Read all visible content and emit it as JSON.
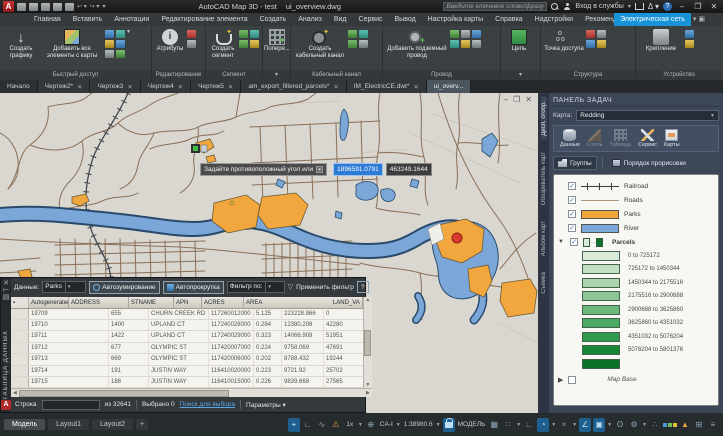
{
  "titlebar": {
    "app_title": "AutoCAD Map 3D - test",
    "doc_name": "ui_overview.dwg",
    "search_placeholder": "Введите ключевое слово/фразу",
    "signin_label": "Вход в службы"
  },
  "ribbon_tabs": [
    "Главная",
    "Вставить",
    "Аннотации",
    "Редактирование элемента",
    "Создать",
    "Анализ",
    "Вид",
    "Сервис",
    "Вывод",
    "Настройка карты",
    "Справка",
    "Надстройки",
    "Рекомендованные приложения"
  ],
  "active_ribbon_tab": "Электрическая сеть",
  "ribbon": {
    "g0": {
      "label": "Быстрый доступ",
      "b0": "Создать графику",
      "b1": "Добавить все элементы с карты"
    },
    "g1": {
      "label": "Редактирование",
      "b0": "Атрибуты"
    },
    "g2": {
      "label": "Сегмент",
      "b0": "Создать сегмент"
    },
    "g3": {
      "label": "",
      "b0": "Попере..."
    },
    "g4": {
      "label": "Кабельный канал",
      "b0": "Создать кабельный канал"
    },
    "g5": {
      "label": "Провод",
      "b0": "Добавить подземный провод"
    },
    "g6": {
      "label": "",
      "b0": "Цепь"
    },
    "g7": {
      "label": "Структура",
      "b0": "Точка доступа"
    },
    "g8": {
      "label": "Устройство",
      "b0": "Крепление"
    }
  },
  "doc_tabs": {
    "start": "Начало",
    "closable": [
      {
        "label": "Чертеж2*"
      },
      {
        "label": "Чертеж3"
      },
      {
        "label": "Чертеж4"
      },
      {
        "label": "Чертеж5"
      },
      {
        "label": "am_export_filtered_parcels*"
      },
      {
        "label": "IM_ElectricCE.dwt*"
      }
    ],
    "active": "ui_overv..."
  },
  "tooltip": {
    "prompt": "Задайте противоположный угол или",
    "x_value": "1896591.0791",
    "y_value": "463249.1644"
  },
  "datatable": {
    "strip_title": "ТАБЛИЦА ДАННЫХ",
    "toolbar": {
      "data_label": "Данные:",
      "layer_value": "Parks",
      "autozoom": "Автозумирование",
      "autoscroll": "Автопрокрутка",
      "filter_label": "Фильтр по:",
      "apply_filter": "Применить фильтр",
      "help": "?"
    },
    "columns": [
      "Autogenerated_SDF_ID",
      "ADDRESS",
      "STNAME",
      "APN",
      "ACRES",
      "AREA",
      "LAND_VA"
    ],
    "rows": [
      [
        "19709",
        "655",
        "CHURN CREEK RD",
        "117260012000",
        "5.125",
        "223228.866",
        "0"
      ],
      [
        "19710",
        "1400",
        "UPLAND CT",
        "117240028000",
        "0.284",
        "12380.208",
        "42280"
      ],
      [
        "19711",
        "1422",
        "UPLAND CT",
        "117240029000",
        "0.323",
        "14066.909",
        "51951"
      ],
      [
        "19712",
        "677",
        "OLYMPIC ST",
        "117420007000",
        "0.224",
        "9758.069",
        "47691"
      ],
      [
        "19713",
        "669",
        "OLYMPIC ST",
        "117420006000",
        "0.202",
        "8788.432",
        "19244"
      ],
      [
        "19714",
        "191",
        "JUSTIN WAY",
        "116410020000",
        "0.223",
        "9721.92",
        "25702"
      ],
      [
        "19715",
        "188",
        "JUSTIN WAY",
        "116410015000",
        "0.226",
        "9839.668",
        "27565"
      ]
    ],
    "footer": {
      "row_label": "Строка",
      "of_total": "из 32641",
      "selected": "Выбрано 0",
      "search_link": "Поиск для выбора",
      "params": "Параметры"
    }
  },
  "side_tabs": [
    "Дисп. отобр.",
    "Обозреватель карт",
    "Альбом карт",
    "Съемка"
  ],
  "taskpane": {
    "title": "ПАНЕЛЬ ЗАДАЧ",
    "map_label": "Карта:",
    "map_value": "Redding",
    "tools": [
      "Данные",
      "Стиль",
      "Таблица",
      "Сервис",
      "Карты"
    ],
    "groups_btn": "Группы",
    "draworder_btn": "Порядок прорисовки",
    "legend_items": [
      {
        "label": "Railroad"
      },
      {
        "label": "Roads",
        "color": "#b1957a"
      },
      {
        "label": "Parks",
        "color": "#f0a63c"
      },
      {
        "label": "River",
        "color": "#7ba7d9"
      },
      {
        "label": "Parcels"
      }
    ],
    "parcels_ramp": [
      {
        "label": "0 to 725172",
        "color": "#d9ecd9"
      },
      {
        "label": "725172 to 1450344",
        "color": "#c2e0c4"
      },
      {
        "label": "1450344 to 2175516",
        "color": "#a9d4ae"
      },
      {
        "label": "2175516 to 2900688",
        "color": "#8cc795"
      },
      {
        "label": "2900688 to 3625860",
        "color": "#6cb97c"
      },
      {
        "label": "3625860 to 4351032",
        "color": "#4aa962"
      },
      {
        "label": "4351032 to 5076204",
        "color": "#2f9a4b"
      },
      {
        "label": "5076204 to 5801376",
        "color": "#178736"
      },
      {
        "label": "",
        "color": "#0b7029"
      }
    ],
    "map_base": "Map Base"
  },
  "statusbar": {
    "model_tabs": [
      "Модель",
      "Layout1",
      "Layout2"
    ],
    "add_tab": "+",
    "annot_scale": "1x",
    "coord_system": "CA-I",
    "scale": "1:38980.6",
    "model_label": "МОДЕЛЬ"
  },
  "colors": {
    "accent_blue": "#1793d7",
    "park_orange": "#f2a73e",
    "river_blue": "#7aa7d8",
    "road_brown": "#8a7059",
    "map_bg": "#d9d7d0"
  }
}
